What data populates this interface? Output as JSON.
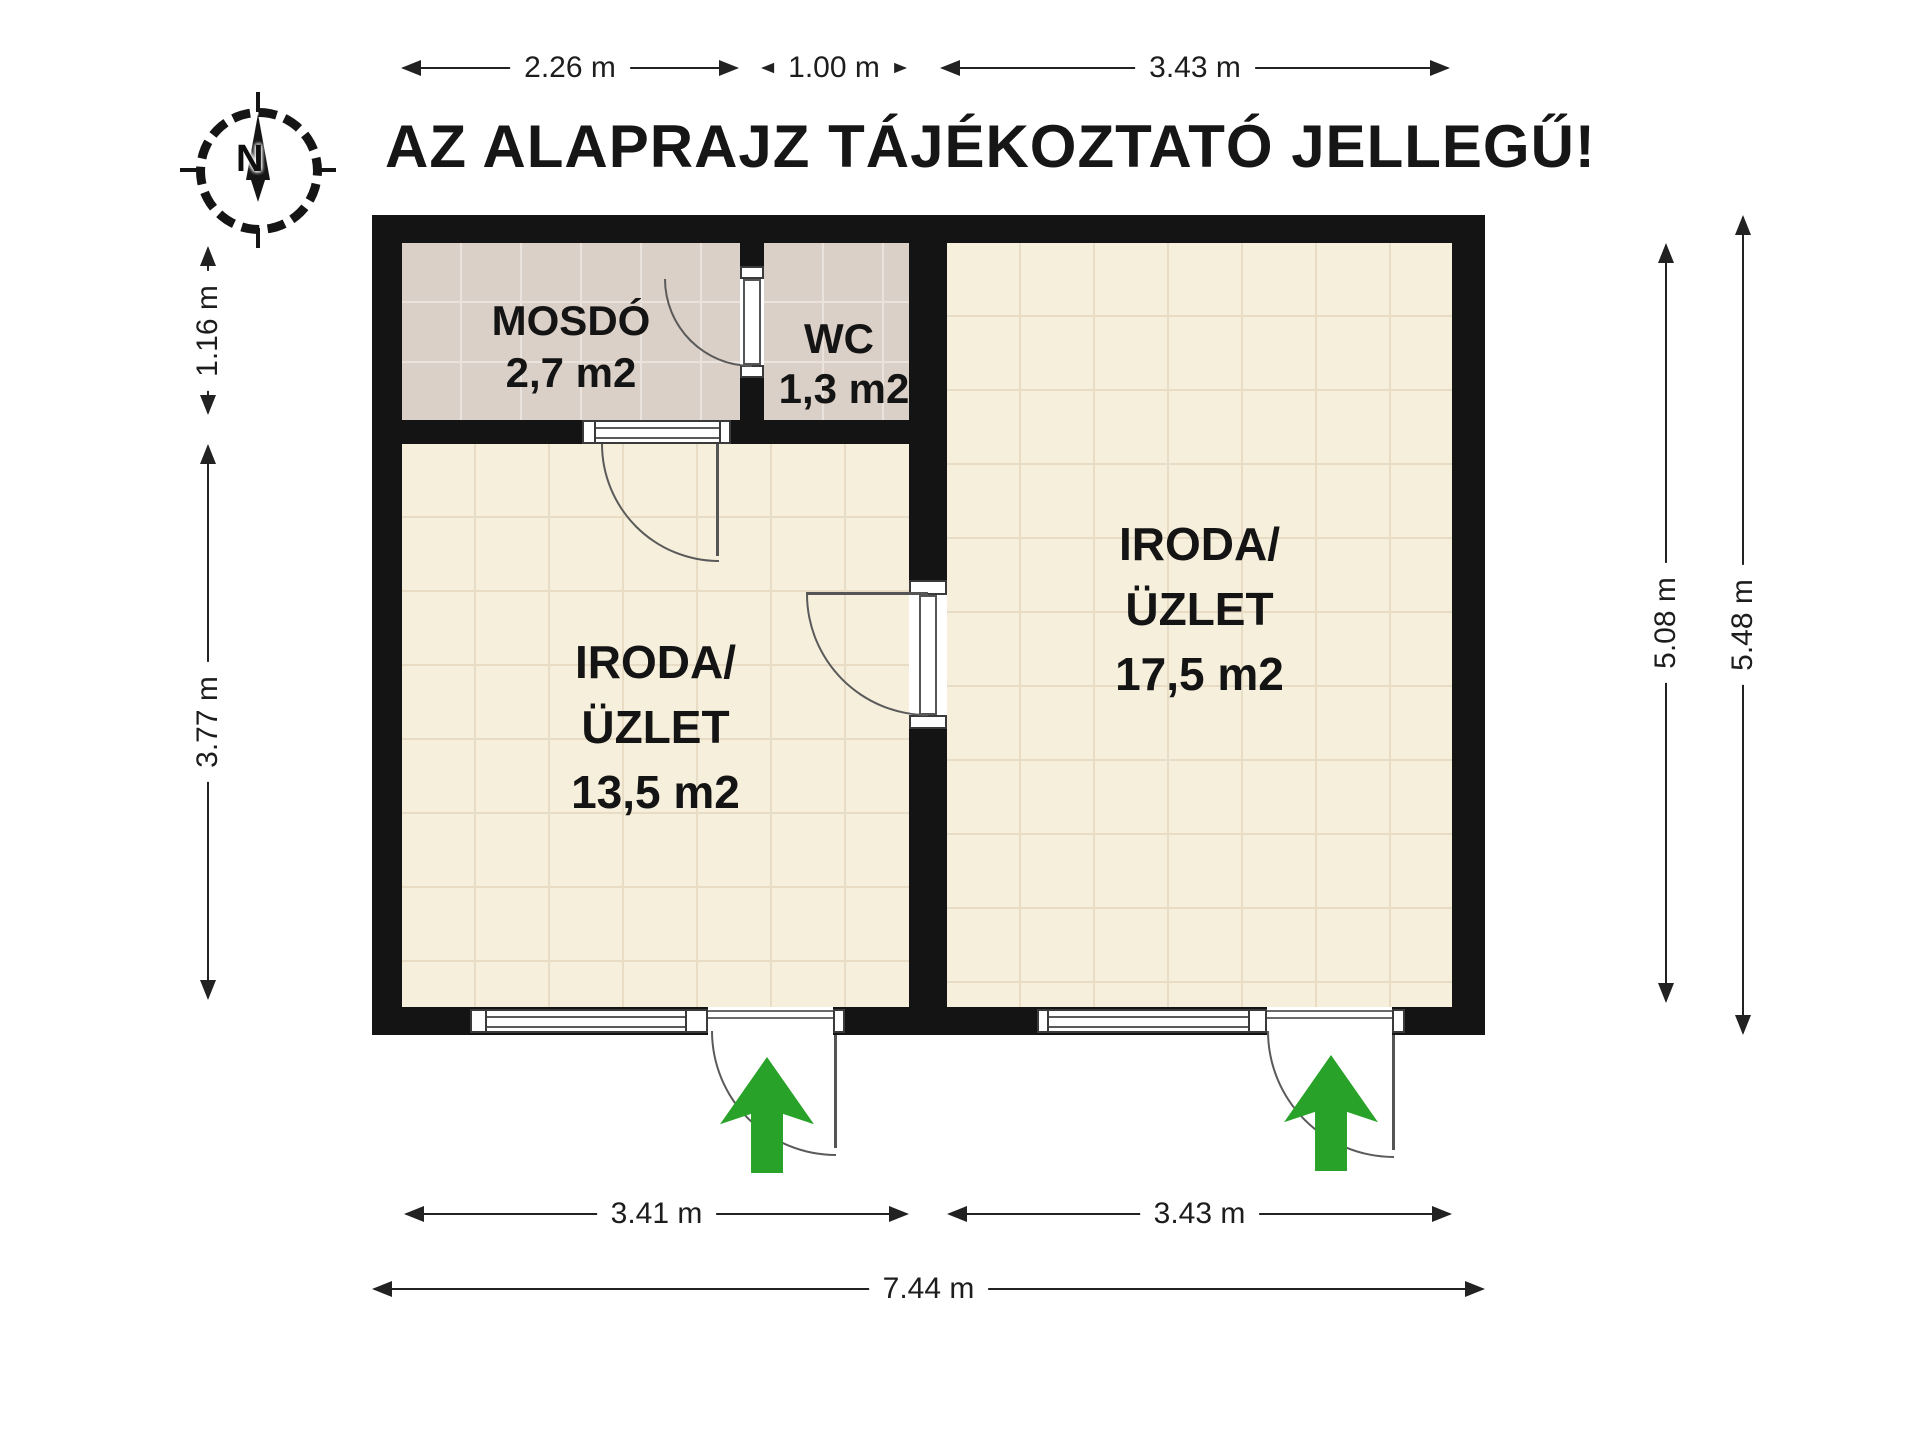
{
  "title": "AZ ALAPRAJZ TÁJÉKOZTATÓ JELLEGŰ!",
  "compass": {
    "north_label": "N"
  },
  "rooms": [
    {
      "id": "mosdo",
      "name": "MOSDÓ",
      "area": "2,7 m2"
    },
    {
      "id": "wc",
      "name": "WC",
      "area": "1,3 m2"
    },
    {
      "id": "iroda1",
      "name": "IRODA/",
      "name2": "ÜZLET",
      "area": "13,5 m2"
    },
    {
      "id": "iroda2",
      "name": "IRODA/",
      "name2": "ÜZLET",
      "area": "17,5 m2"
    }
  ],
  "dimensions": {
    "top": [
      "2.26 m",
      "1.00 m",
      "3.43 m"
    ],
    "left": [
      "1.16 m",
      "3.77 m"
    ],
    "right": [
      "5.08 m",
      "5.48 m"
    ],
    "bottom": [
      "3.41 m",
      "3.43 m"
    ],
    "total_width": "7.44 m"
  },
  "colors": {
    "wall": "#141414",
    "floor_cream": "#f6efdc",
    "floor_pink": "#dbd0c8",
    "entrance_arrow_green": "#28a228"
  }
}
